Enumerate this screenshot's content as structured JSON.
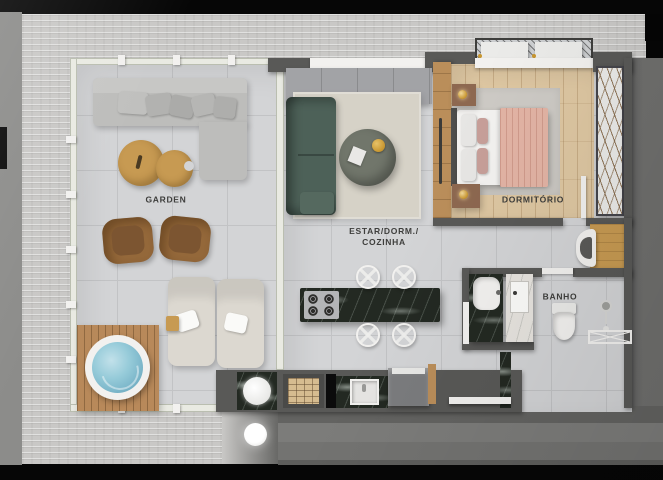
{
  "rooms": {
    "garden": {
      "label": "GARDEN"
    },
    "living": {
      "label": "ESTAR/DORM./\nCOZINHA"
    },
    "bedroom": {
      "label": "DORMITÓRIO"
    },
    "bathroom": {
      "label": "BANHO"
    }
  },
  "theme": {
    "canvas_bg": "#060606",
    "outside_gray": "#8c8c8a",
    "concrete": "#c9c8c6",
    "corridor_dark": "#696967",
    "floor_tile": "#d3d4d6",
    "tile_line": "#c2c3c5",
    "wall_dark": "#595957",
    "glass_frame": "#e9eae2",
    "wood_floor": "#dec7a2",
    "wood_mid": "#ba8e5a",
    "wood_table": "#c79a52",
    "deck_wood": "#b8895a",
    "marble_dark": "#232922",
    "marble_white": "#e7e4df",
    "sofa_gray": "#bdbdbb",
    "sofa_green": "#4d6158",
    "rug_beige": "#d6d2c7",
    "rug_gray": "#cdcac5",
    "bed_white": "#f3f2f0",
    "blanket_pink": "#e3b4a5",
    "lounger_cream": "#dcd8d0",
    "water_blue": "#7fb9cc",
    "brick_tan": "#d6bc90",
    "gold": "#c8962f",
    "fixture_white": "#f2f1ef",
    "cabinet_gray": "#a2a3a6",
    "appliance_gray": "#7b7c7e",
    "label_text": "#3e3e3c"
  }
}
